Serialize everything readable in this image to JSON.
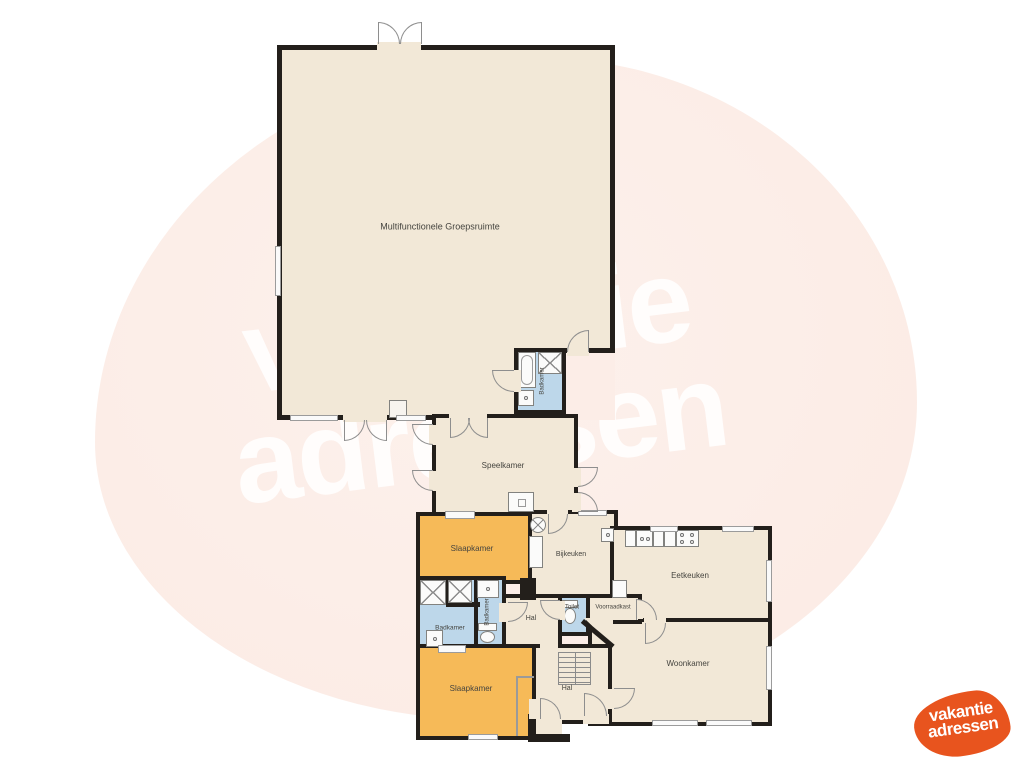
{
  "watermark": {
    "line1": "vakantie",
    "line2": "adressen"
  },
  "logo": {
    "line1": "vakantie",
    "line2": "adressen",
    "color": "#e8541e"
  },
  "colors": {
    "outside_blob": "#fcede7",
    "floor": "#f2e8d7",
    "bedroom_floor": "#f6ba58",
    "bathroom_floor": "#bdd7ea",
    "wall": "#231f1b",
    "watermark_text": "rgba(255,255,255,0.85)"
  },
  "rooms": {
    "groepsruimte": {
      "label": "Multifunctionele Groepsruimte"
    },
    "badkamer_boven": {
      "label": "Badkamer"
    },
    "speelkamer": {
      "label": "Speelkamer"
    },
    "slaapkamer_boven": {
      "label": "Slaapkamer"
    },
    "bijkeuken": {
      "label": "Bijkeuken"
    },
    "eetkeuken": {
      "label": "Eetkeuken"
    },
    "voorraadkast": {
      "label": "Voorraadkast"
    },
    "toilet": {
      "label": "Toilet"
    },
    "hal_midden": {
      "label": "Hal"
    },
    "badkamer_links": {
      "label": "Badkamer"
    },
    "badkamer_midden": {
      "label": "Badkamer"
    },
    "slaapkamer_beneden": {
      "label": "Slaapkamer"
    },
    "hal_beneden": {
      "label": "Hal"
    },
    "woonkamer": {
      "label": "Woonkamer"
    }
  },
  "icons": {
    "shower-icon": "crossed-square",
    "bathtub-icon": "rounded-tub",
    "sink-icon": "basin-with-dot",
    "toilet-icon": "cistern-and-bowl",
    "washing-machine-icon": "crossed-circle",
    "stove-icon": "four-burner-dots",
    "kitchen-sink-icon": "basin-two-dots",
    "stairs-icon": "tread-lines",
    "door-icon": "quarter-circle-arc",
    "window-icon": "double-line-segment",
    "chimney-icon": "hollow-square"
  }
}
